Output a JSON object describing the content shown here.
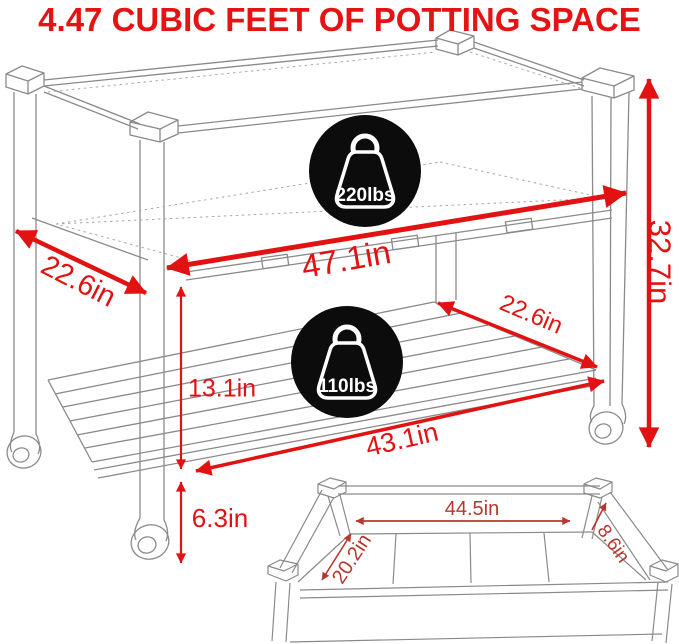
{
  "title": "4.47 CUBIC FEET OF POTTING SPACE",
  "colors": {
    "main_red": "#e21212",
    "inset_red": "#b5382f",
    "line_gray": "#8a8a8a",
    "badge_black": "#0c0c0c"
  },
  "badges": {
    "top": {
      "label": "220lbs",
      "icon": "weight-icon"
    },
    "shelf": {
      "label": "110lbs",
      "icon": "weight-icon"
    }
  },
  "dims": {
    "top_depth": "22.6in",
    "top_width": "47.1in",
    "overall_height": "32.7in",
    "shelf_depth": "22.6in",
    "box_to_shelf": "13.1in",
    "shelf_width": "43.1in",
    "ground_clearance": "6.3in",
    "inner_length": "44.5in",
    "inner_width": "20.2in",
    "inner_depth": "8.6in"
  }
}
